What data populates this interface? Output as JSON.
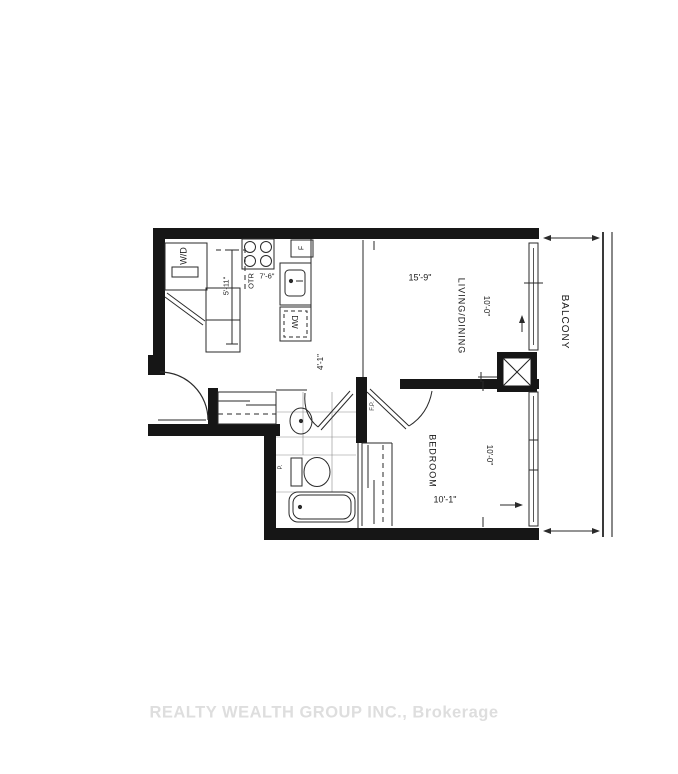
{
  "watermark": {
    "text": "REALTY WEALTH GROUP INC., Brokerage"
  },
  "plan": {
    "rooms": {
      "living_dining": {
        "name": "LIVING/DINING",
        "width": "15'-9\"",
        "depth": "10'-0\""
      },
      "bedroom": {
        "name": "BEDROOM",
        "width": "10'-1\"",
        "depth": "10'-0\""
      },
      "balcony": {
        "name": "BALCONY"
      },
      "kitchen": {
        "run_length": "7'-6\"",
        "aisle_length": "5'-11\""
      },
      "hall": {
        "width": "4'-1\""
      }
    },
    "fixtures": {
      "washer_dryer": "W/D",
      "over_the_range": "OTR",
      "dishwasher": "DW",
      "fridge": "F",
      "door_note": "F.P.",
      "plumbing_note": "P."
    }
  }
}
